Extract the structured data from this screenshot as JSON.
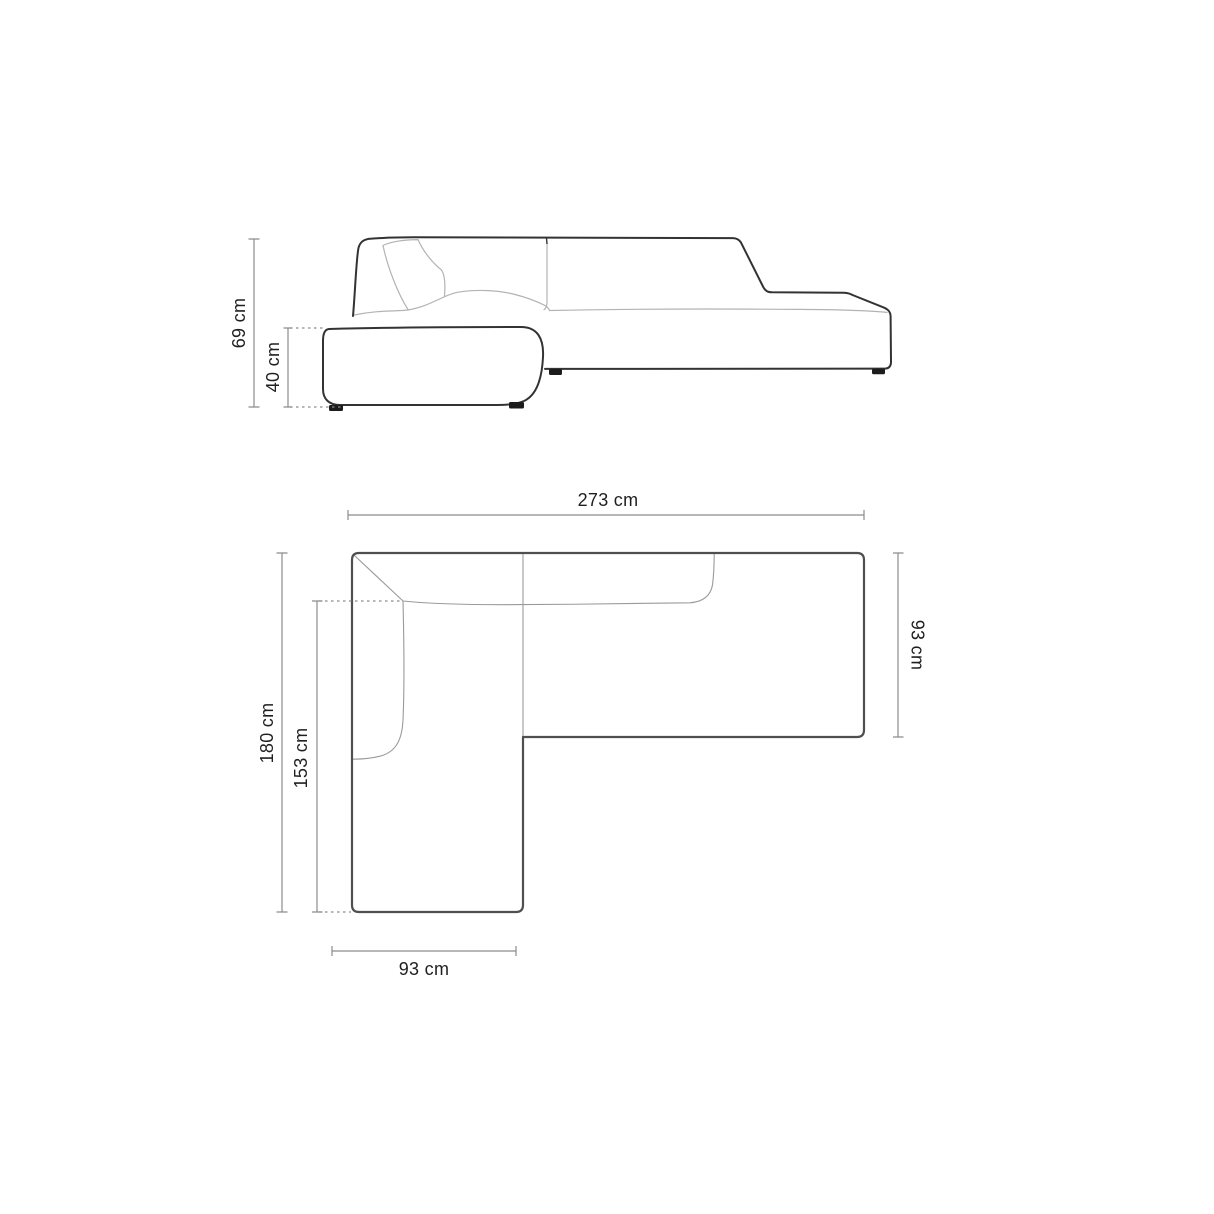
{
  "diagram": {
    "side_view": {
      "total_height": "69 cm",
      "seat_height": "40 cm"
    },
    "plan_view": {
      "total_width": "273 cm",
      "right_depth": "93 cm",
      "total_depth": "180 cm",
      "chaise_inner_depth": "153 cm",
      "chaise_width": "93 cm"
    },
    "colors": {
      "background": "#ffffff",
      "sofa_outline": "#333333",
      "sofa_detail_line": "#b3b3b3",
      "plan_outline": "#4f4f4f",
      "plan_detail_line": "#9a9a9a",
      "dimension_line": "#8c8c8c",
      "label_text": "#1f1f1f"
    }
  }
}
